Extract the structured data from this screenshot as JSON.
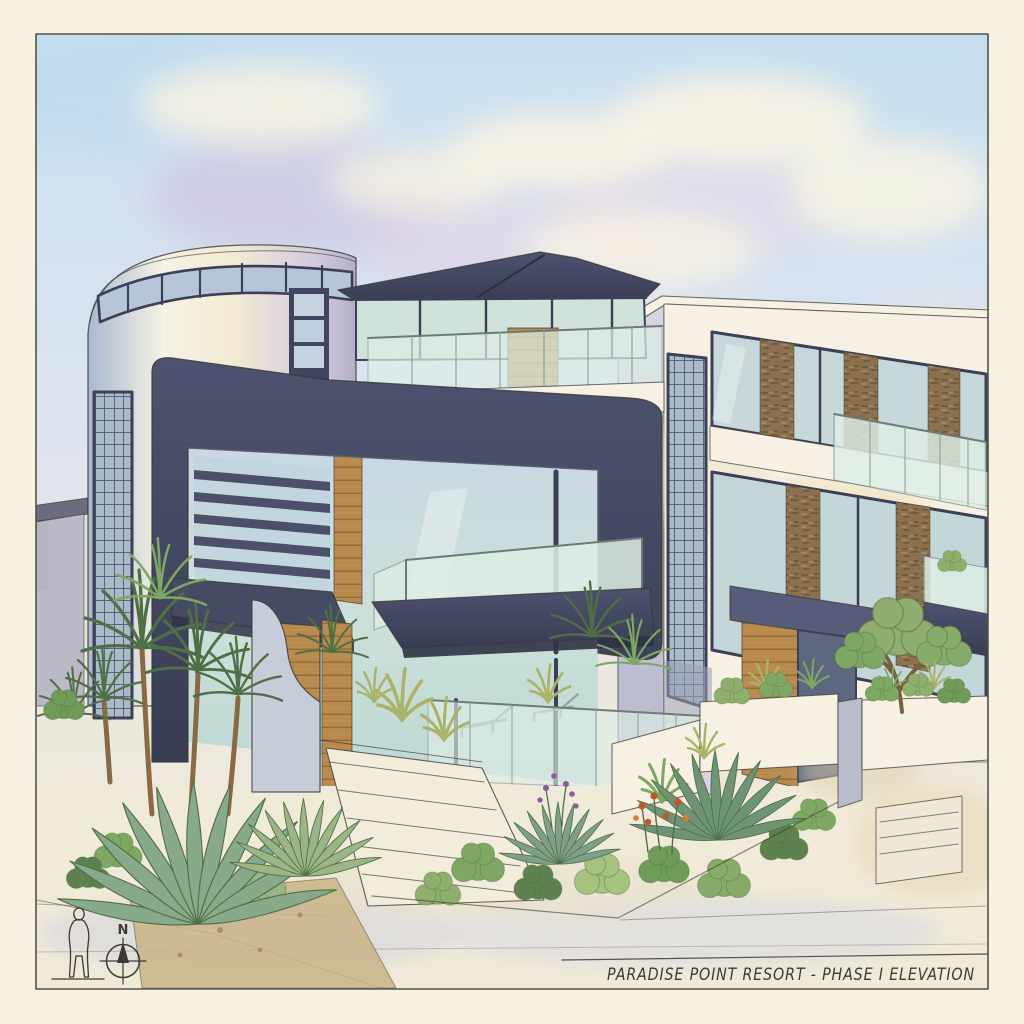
{
  "title_block": {
    "text": "PARADISE POINT RESORT - PHASE I ELEVATION"
  },
  "compass": {
    "north_label": "N"
  },
  "palette": {
    "paper": "#f6f1e1",
    "frameInk": "#55524a",
    "ink": "#3c3a34",
    "charcoalDark": "#3b4058",
    "charcoal": "#4a5068",
    "charcoalLight": "#565c7a",
    "glassGreen": "#cfe3da",
    "glassBlue": "#b9c9da",
    "glassPale": "#ddeee6",
    "wood": "#b98a4e",
    "woodDark": "#8a6234",
    "stone": "#8b7150",
    "whiteWall": "#f6f1e2",
    "creamWash": "#f0e6cd",
    "lavenderWall": "#c9c6da",
    "grayWall": "#b9bccb",
    "skyBlue": "#c8dff0",
    "skyLavender": "#cdbfdf",
    "skyPink": "#ecd5e2",
    "cloud": "#f8f3e3",
    "greenDark": "#4f7046",
    "greenMid": "#7ea763",
    "greenLight": "#a9c487",
    "greenBlue": "#88a98a",
    "flowerRed": "#c2562f",
    "flowerPurple": "#8d5a9e",
    "soil": "#c9b488",
    "groundShadow": "#c9cbd9",
    "trunkBrown": "#8a6a44"
  }
}
